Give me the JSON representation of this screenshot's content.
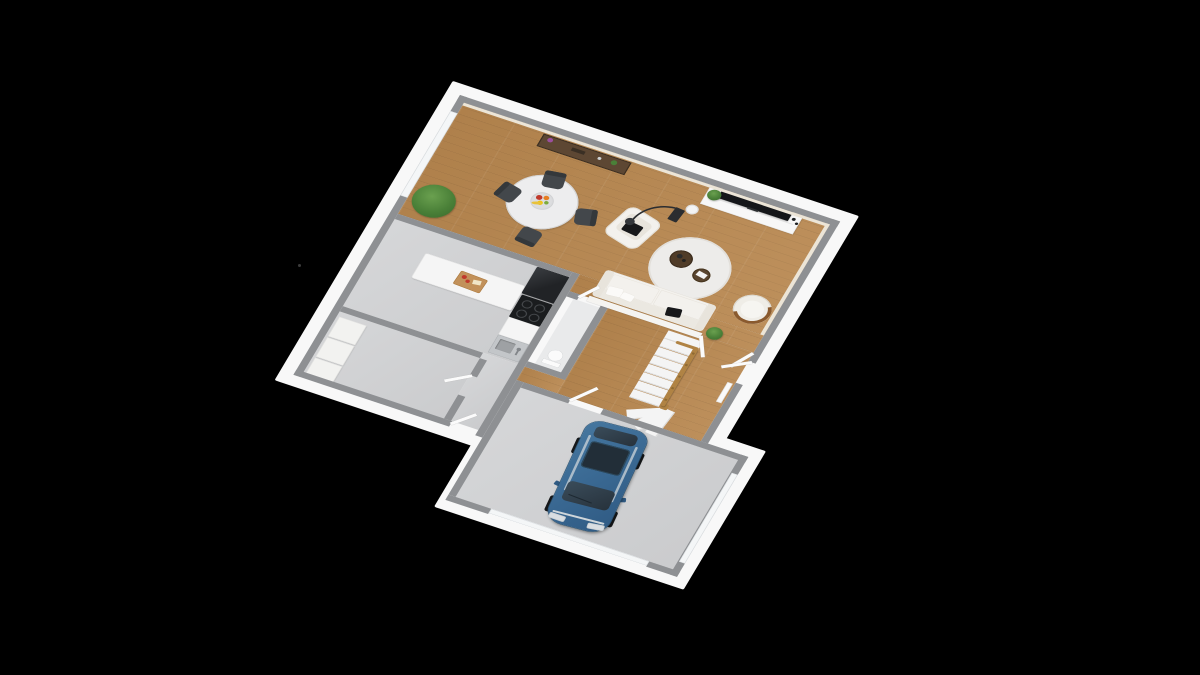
{
  "scene": {
    "description": "3d-rendered-ground-floor-plan",
    "background": "#000000",
    "colors": {
      "background": "#000000",
      "plinth": "#f8f8f8",
      "wallCap": "#8e9093",
      "wallFace": "#ece5d7",
      "halfWall": "#f5f4f1",
      "woodFloor": "#b8874f",
      "greyFloor": "#d3d4d6",
      "wcFloor": "#e9eaeb",
      "window": "#f4f6f7",
      "door": "#fbfbfb",
      "counter": "#f5f5f5",
      "fridge": "#212326",
      "cooktop": "#1a1c1e",
      "burner": "#44474a",
      "sink": "#c3c6c9",
      "sinkBasin": "#9ea1a4",
      "cuttingBoard": "#c2915a",
      "sofa": "#f3f1ed",
      "sofaShade": "#e8e4dc",
      "pillowBlack": "#17181a",
      "pillowWhite": "#fbfaf8",
      "chairGrey": "#43474b",
      "tableTop": "#ededee",
      "tableRim": "#d5d5d5",
      "consoleWood": "#5d4733",
      "consoleFrame": "#3e3022",
      "rug": "#edecea",
      "coffeeDark": "#503c28",
      "coffeeMid": "#5a452f",
      "plantGreen": "#4a8038",
      "plantDark": "#39682b",
      "tvBlack": "#141619",
      "tvUnit": "#f7f7f7",
      "lampBlack": "#2b2d30",
      "stairStep": "#f4f4f4",
      "stairEdge": "#dadada",
      "banister": "#b08344",
      "banisterDark": "#8f6a33",
      "tubChair": "#efede7",
      "tubWood": "#8a5a2e",
      "bench": "#f2f2f0",
      "radiator": "#fafafa",
      "carBody": "#3b6a94",
      "carBodyDark": "#2f5a83",
      "carGlass": "#27323c",
      "carRoofGlass": "#222e38",
      "carChrome": "#cfd6da",
      "carWheel": "#16181a",
      "fruitRed": "#c0392b",
      "fruitOrange": "#e67e22",
      "fruitYellow": "#f1c40f",
      "fruitGreen": "#7dab3c"
    },
    "rooms": [
      {
        "name": "living-dining-room",
        "floor": "wood"
      },
      {
        "name": "kitchen",
        "floor": "grey-concrete"
      },
      {
        "name": "hallway-stairs",
        "floor": "wood"
      },
      {
        "name": "wc",
        "floor": "light-grey"
      },
      {
        "name": "utility-room",
        "floor": "grey-concrete"
      },
      {
        "name": "corridor",
        "floor": "grey-concrete"
      },
      {
        "name": "garage",
        "floor": "grey-concrete"
      }
    ],
    "furniture": {
      "dining_chairs": 4,
      "dining_table": 1,
      "console_table": 1,
      "armchair": 1,
      "sofa": 1,
      "tub_chair": 1,
      "coffee_tables": 2,
      "tv": 1,
      "tv_unit": 1,
      "arc_lamp": 1,
      "rug": 1,
      "plants": 4,
      "kitchen_island": 1,
      "fridge": 1,
      "cooktop": 1,
      "sink": 1,
      "toilet": 1,
      "utility_benches": 3,
      "doors_open": 7
    },
    "stairs": {
      "steps": 7,
      "winders": 3,
      "landing": 1,
      "banister": "oak"
    },
    "car": {
      "type": "minivan",
      "bodyColor": "#3b6a94",
      "parked_in": "garage"
    }
  }
}
